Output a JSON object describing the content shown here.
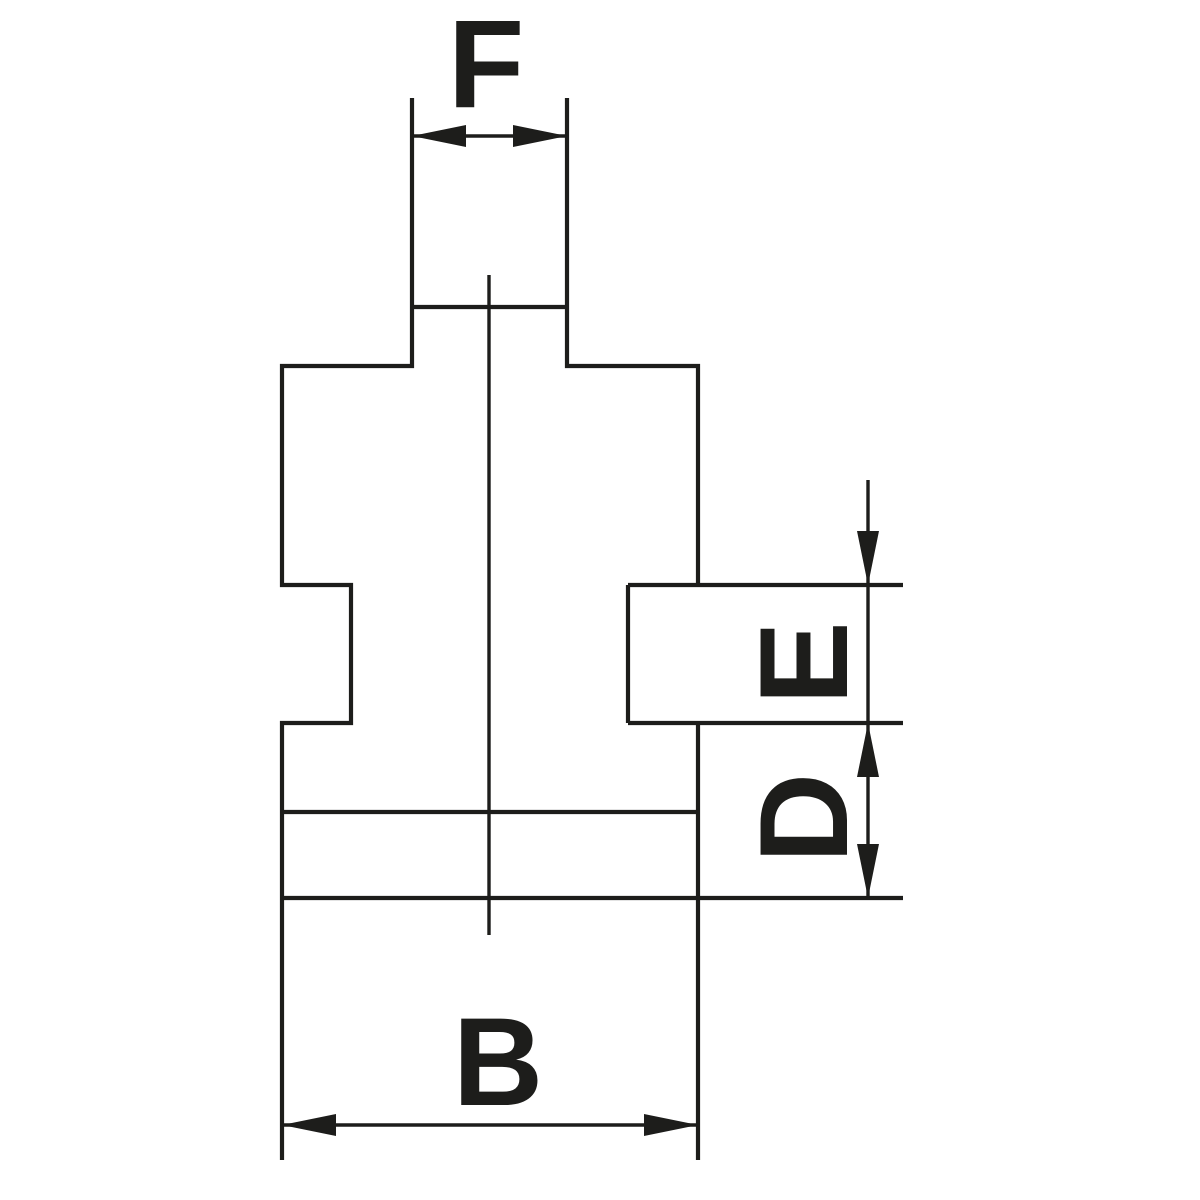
{
  "diagram": {
    "dimension_labels": {
      "f": "F",
      "e": "E",
      "d": "D",
      "b": "B"
    },
    "colors": {
      "line": "#1d1d1b",
      "background": "#ffffff"
    }
  }
}
